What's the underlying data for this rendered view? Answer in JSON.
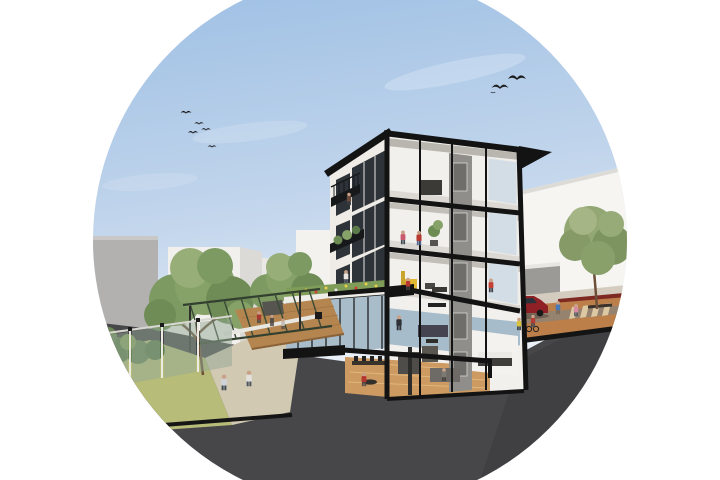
{
  "scene": {
    "description": "Circular architectural rendering: cross-section of a five-storey building with rooftop terrace, courtyard garden with pergola and trees, ground-floor lounge, basement, street with red car and cyclists, background buildings and flying birds",
    "mask_shape": "circle",
    "floors": [
      "roof",
      "upper-apartment",
      "apartment",
      "terrace-level",
      "ground-floor",
      "basement"
    ],
    "tree_count": 4,
    "bird_count": 8,
    "vehicle": "red-car"
  },
  "palette": {
    "page_bg": "#ffffff",
    "sky_top": "#9dbfe4",
    "sky_mid": "#c3d6ec",
    "sky_horizon": "#e9f0f7",
    "earth": "#47474a",
    "earth_dark": "#3a3a3d",
    "slab": "#131313",
    "facade": "#efece7",
    "interior_wall": "#f2f0ec",
    "core": "#8f8e8a",
    "glass": "#a9bcca",
    "floor_blue": "#a7bccb",
    "wood": "#cd9a61",
    "deck": "#b5854f",
    "grass": "#b8bc79",
    "path": "#d2c9b2",
    "foliage": "#7d9a62",
    "foliage_dark": "#5d7a4a",
    "foliage_light": "#97ae79",
    "street_tan": "#bd7f49",
    "sidewalk": "#d5ccc0",
    "road": "#95826f",
    "band_red": "#7e2a22",
    "car_red": "#8e2026",
    "bldg_gray": "#b2b1af",
    "bldg_white": "#f1f0ed",
    "bldg_white_right": "#f6f5f2",
    "trunk": "#6d4f38",
    "terrace_green": "#7f9c58",
    "flower_yellow": "#e6cf4a"
  },
  "birds": [
    {
      "x": 186,
      "y": 113,
      "s": 0.9
    },
    {
      "x": 199,
      "y": 124,
      "s": 0.8
    },
    {
      "x": 193,
      "y": 133,
      "s": 0.85
    },
    {
      "x": 206,
      "y": 130,
      "s": 0.8
    },
    {
      "x": 212,
      "y": 147,
      "s": 0.75
    },
    {
      "x": 500,
      "y": 88,
      "s": 1.4
    },
    {
      "x": 517,
      "y": 79,
      "s": 1.5
    },
    {
      "x": 493,
      "y": 93,
      "s": 0.45
    }
  ],
  "people": [
    {
      "role": "balcony-resident",
      "x": 349,
      "y": 205,
      "s": 1.0,
      "top": "#6b4a3e",
      "bottom": "#3a3a42"
    },
    {
      "role": "terrace-resident",
      "x": 346,
      "y": 283,
      "s": 1.05,
      "top": "#e8e5e0",
      "bottom": "#5a5e66"
    },
    {
      "role": "fourth-floor-resident",
      "x": 403,
      "y": 244,
      "s": 1.1,
      "top": "#c95a6e",
      "bottom": "#3f4850"
    },
    {
      "role": "fourth-floor-resident-red",
      "x": 419,
      "y": 245,
      "s": 1.15,
      "top": "#b8372f",
      "bottom": "#51688c"
    },
    {
      "role": "third-floor-sitter",
      "x": 408,
      "y": 290,
      "s": 1.0,
      "top": "#b8372f",
      "bottom": "#44413e"
    },
    {
      "role": "gallery-walker",
      "x": 491,
      "y": 292,
      "s": 1.1,
      "top": "#c24034",
      "bottom": "#3c3f47"
    },
    {
      "role": "office-man",
      "x": 399,
      "y": 330,
      "s": 1.2,
      "top": "#2e3136",
      "bottom": "#2e3136"
    },
    {
      "role": "lounge-sitter",
      "x": 364,
      "y": 386,
      "s": 1.1,
      "top": "#b5362e",
      "bottom": "#4e4a46"
    },
    {
      "role": "sofa-sitter",
      "x": 444,
      "y": 381,
      "s": 1.05,
      "top": "#7d7a74",
      "bottom": "#44423e"
    },
    {
      "role": "deck-sitter-red",
      "x": 259,
      "y": 323,
      "s": 0.95,
      "top": "#a8372f",
      "bottom": "#4a4440"
    },
    {
      "role": "deck-sitter-dark",
      "x": 272,
      "y": 326,
      "s": 0.9,
      "top": "#574f49",
      "bottom": "#3c3835"
    },
    {
      "role": "deck-sitter-light",
      "x": 283,
      "y": 329,
      "s": 0.85,
      "top": "#c5beb4",
      "bottom": "#514b45"
    },
    {
      "role": "courtyard-walker-blue",
      "x": 224,
      "y": 390,
      "s": 1.25,
      "top": "#cfd3d8",
      "bottom": "#3f4a57"
    },
    {
      "role": "courtyard-walker-white",
      "x": 249,
      "y": 386,
      "s": 1.25,
      "top": "#e3e1dc",
      "bottom": "#4c5560"
    },
    {
      "role": "street-pedestrian",
      "x": 558,
      "y": 314,
      "s": 1.05,
      "top": "#4a7ab5",
      "bottom": "#7b6a55"
    },
    {
      "role": "street-pedestrian-pink",
      "x": 576,
      "y": 316,
      "s": 1.0,
      "top": "#d88aa0",
      "bottom": "#4e5a66"
    },
    {
      "role": "cyclist-yellow",
      "x": 519,
      "y": 330,
      "s": 1.0,
      "top": "#d8c33a",
      "bottom": "#3a3f45"
    },
    {
      "role": "cyclist-red",
      "x": 533,
      "y": 327,
      "s": 1.0,
      "top": "#b23d33",
      "bottom": "#434750"
    }
  ]
}
